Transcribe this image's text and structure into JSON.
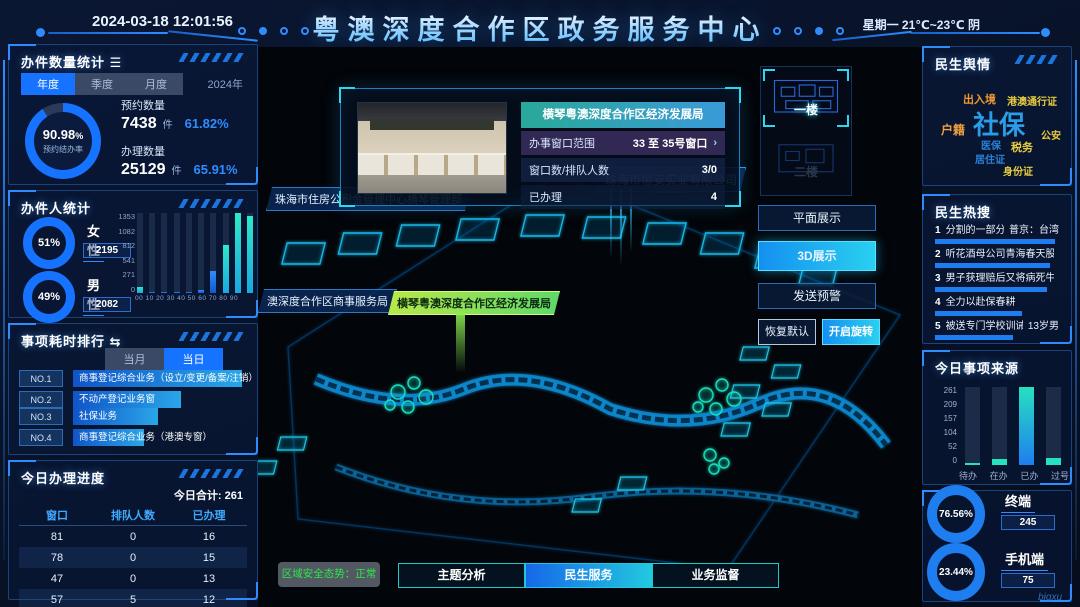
{
  "colors": {
    "accent_blue": "#1673ff",
    "bright_cyan": "#29c9f0",
    "teal": "#27e0c0",
    "donut_track": "#2a3a58",
    "green_status": "#2ae84a",
    "bar_blue": "#1e7ef0"
  },
  "header": {
    "datetime": "2024-03-18 12:01:56",
    "title": "粤澳深度合作区政务服务中心",
    "weather": "星期一 21℃~23℃ 阴"
  },
  "left": {
    "volume": {
      "title": "办件数量统计",
      "title_icon": "☰",
      "tabs": [
        "年度",
        "季度",
        "月度"
      ],
      "active_tab": "年度",
      "year": "2024年",
      "donut_value": "90.98",
      "donut_unit": "%",
      "donut_label": "预约结办率",
      "donut_percent": 90.98,
      "stats": [
        {
          "label": "预约数量",
          "value": "7438",
          "unit": "件",
          "percent": "61.82%"
        },
        {
          "label": "办理数量",
          "value": "25129",
          "unit": "件",
          "percent": "65.91%"
        }
      ]
    },
    "people": {
      "title": "办件人统计",
      "groups": [
        {
          "percent_text": "51%",
          "percent": 51,
          "label": "女性",
          "count": "2195"
        },
        {
          "percent_text": "49%",
          "percent": 49,
          "label": "男性",
          "count": "2082"
        }
      ]
    },
    "ranking": {
      "title": "事项耗时排行",
      "title_icon": "⇆",
      "tabs": [
        "当月",
        "当日"
      ],
      "active_tab": "当日",
      "items": [
        {
          "rank": "NO.1",
          "label": "商事登记综合业务（设立/变更/备案/注销）",
          "bar_pct": 97
        },
        {
          "rank": "NO.2",
          "label": "不动产登记业务窗",
          "bar_pct": 62
        },
        {
          "rank": "NO.3",
          "label": "社保业务",
          "bar_pct": 49
        },
        {
          "rank": "NO.4",
          "label": "商事登记综合业务（港澳专窗）",
          "bar_pct": 41
        },
        {
          "rank": "NO.5",
          "label": "商事登记发照",
          "bar_pct": 34
        }
      ]
    },
    "progress": {
      "title": "今日办理进度",
      "total": "今日合计: 261",
      "columns": [
        "窗口",
        "排队人数",
        "已办理"
      ],
      "rows": [
        [
          "81",
          "0",
          "16"
        ],
        [
          "78",
          "0",
          "15"
        ],
        [
          "47",
          "0",
          "13"
        ],
        [
          "57",
          "5",
          "12"
        ]
      ]
    }
  },
  "map": {
    "poi_labels": {
      "housing_fund": "珠海市住房公积金管理中心横琴管理部",
      "commerce": "澳深度合作区商事服务局",
      "economy": "横琴粤澳深度合作区经济发展局",
      "company1": "珠海市恒安实业有限公司",
      "company2": "公司"
    },
    "popup": {
      "title": "横琴粤澳深度合作区经济发展局",
      "rows": [
        {
          "label": "办事窗口范围",
          "value": "33 至 35号窗口",
          "arrow": "›"
        },
        {
          "label": "窗口数/排队人数",
          "value": "3/0",
          "arrow": ""
        },
        {
          "label": "已办理",
          "value": "4",
          "arrow": ""
        }
      ]
    },
    "floors": [
      {
        "label": "一楼"
      },
      {
        "label": "二楼"
      }
    ],
    "active_floor": "一楼",
    "view_buttons": [
      "平面展示",
      "3D展示",
      "发送预警"
    ],
    "active_view": "3D展示",
    "small_buttons": [
      "恢复默认",
      "开启旋转"
    ],
    "bottom_tabs": [
      "主题分析",
      "民生服务",
      "业务监督"
    ],
    "active_bottom_tab": "民生服务",
    "security_status": "区域安全态势：正常",
    "watermark": "bigxu"
  },
  "right": {
    "sentiment": {
      "title": "民生舆情",
      "tags": [
        {
          "text": "出入境",
          "color": "#f09830",
          "size": 11
        },
        {
          "text": "港澳通行证",
          "color": "#e8cc40",
          "size": 10
        },
        {
          "text": "社保",
          "color": "#2a9ce8",
          "size": 26
        },
        {
          "text": "户籍",
          "color": "#f0a040",
          "size": 12
        },
        {
          "text": "公安",
          "color": "#e8cc40",
          "size": 10
        },
        {
          "text": "医保",
          "color": "#2a80d8",
          "size": 10
        },
        {
          "text": "税务",
          "color": "#e8cc40",
          "size": 11
        },
        {
          "text": "居住证",
          "color": "#2a80d8",
          "size": 10
        },
        {
          "text": "身份证",
          "color": "#e8cc40",
          "size": 10
        }
      ]
    },
    "hot_search": {
      "title": "民生热搜",
      "items": [
        {
          "rank": "1",
          "text": "分割的一部分",
          "right": "普京：台湾",
          "bar_pct": 97
        },
        {
          "rank": "2",
          "text": "听花酒母公司青海春天股价跌停",
          "right": "",
          "bar_pct": 93
        },
        {
          "rank": "3",
          "text": "男子获理赔后又将病死牛挖出来卖",
          "right": "",
          "bar_pct": 90
        },
        {
          "rank": "4",
          "text": "全力以赴保春耕",
          "right": "",
          "bar_pct": 70
        },
        {
          "rank": "5",
          "text": "被送专门学校训诫",
          "right": "13岁男",
          "bar_pct": 63
        }
      ]
    },
    "source": {
      "title": "今日事项来源"
    },
    "terminals": [
      {
        "percent_text": "76.56%",
        "percent": 76.56,
        "label": "终端",
        "count": "245"
      },
      {
        "percent_text": "23.44%",
        "percent": 23.44,
        "label": "手机端",
        "count": "75"
      }
    ]
  },
  "chart_data": [
    {
      "type": "bar",
      "title": "办件人统计-年龄分布",
      "categories": [
        "00",
        "10",
        "20",
        "30",
        "40",
        "50",
        "60",
        "70",
        "80",
        "90"
      ],
      "categories_text": "00 10 20 30 40 50 60 70 80 90",
      "values": [
        95,
        8,
        6,
        5,
        10,
        55,
        380,
        810,
        1353,
        1300
      ],
      "yticks": [
        0,
        271,
        541,
        812,
        1082,
        1353
      ],
      "yticks_desc": [
        "1353",
        "1082",
        "812",
        "541",
        "271",
        "0"
      ],
      "ylim": [
        0,
        1353
      ]
    },
    {
      "type": "bar",
      "title": "今日事项来源",
      "categories": [
        "待办",
        "在办",
        "已办",
        "过号"
      ],
      "values": [
        8,
        20,
        261,
        25
      ],
      "yticks": [
        0,
        52,
        104,
        157,
        209,
        261
      ],
      "yticks_desc": [
        "261",
        "209",
        "157",
        "104",
        "52",
        "0"
      ],
      "ylim": [
        0,
        261
      ]
    }
  ]
}
